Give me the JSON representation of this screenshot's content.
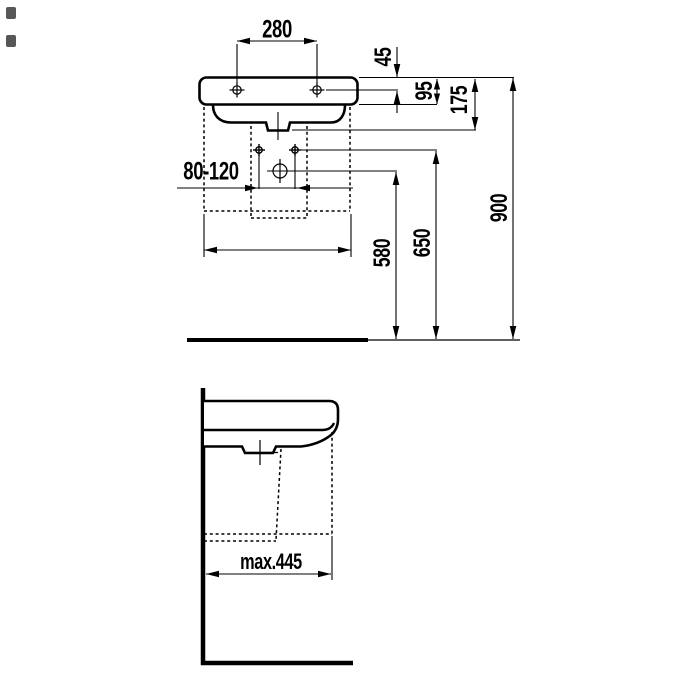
{
  "drawing": {
    "type": "technical dimension drawing",
    "subject": "wall-hung washbasin, front view (top) and side section with wall and floor (bottom)",
    "units": "mm",
    "dimensions": {
      "tap_hole_spacing": "280",
      "rim_to_tap_hole_line": "45",
      "rim_to_body_underside": "95",
      "rim_to_outlet_line": "175",
      "fixing_hole_spacing_range": "80-120",
      "floor_to_trap_center": "580",
      "floor_to_fixing_holes": "650",
      "floor_to_rim": "900",
      "max_wall_projection": "max.445"
    },
    "colors": {
      "line": "#000000",
      "background": "#ffffff"
    }
  }
}
